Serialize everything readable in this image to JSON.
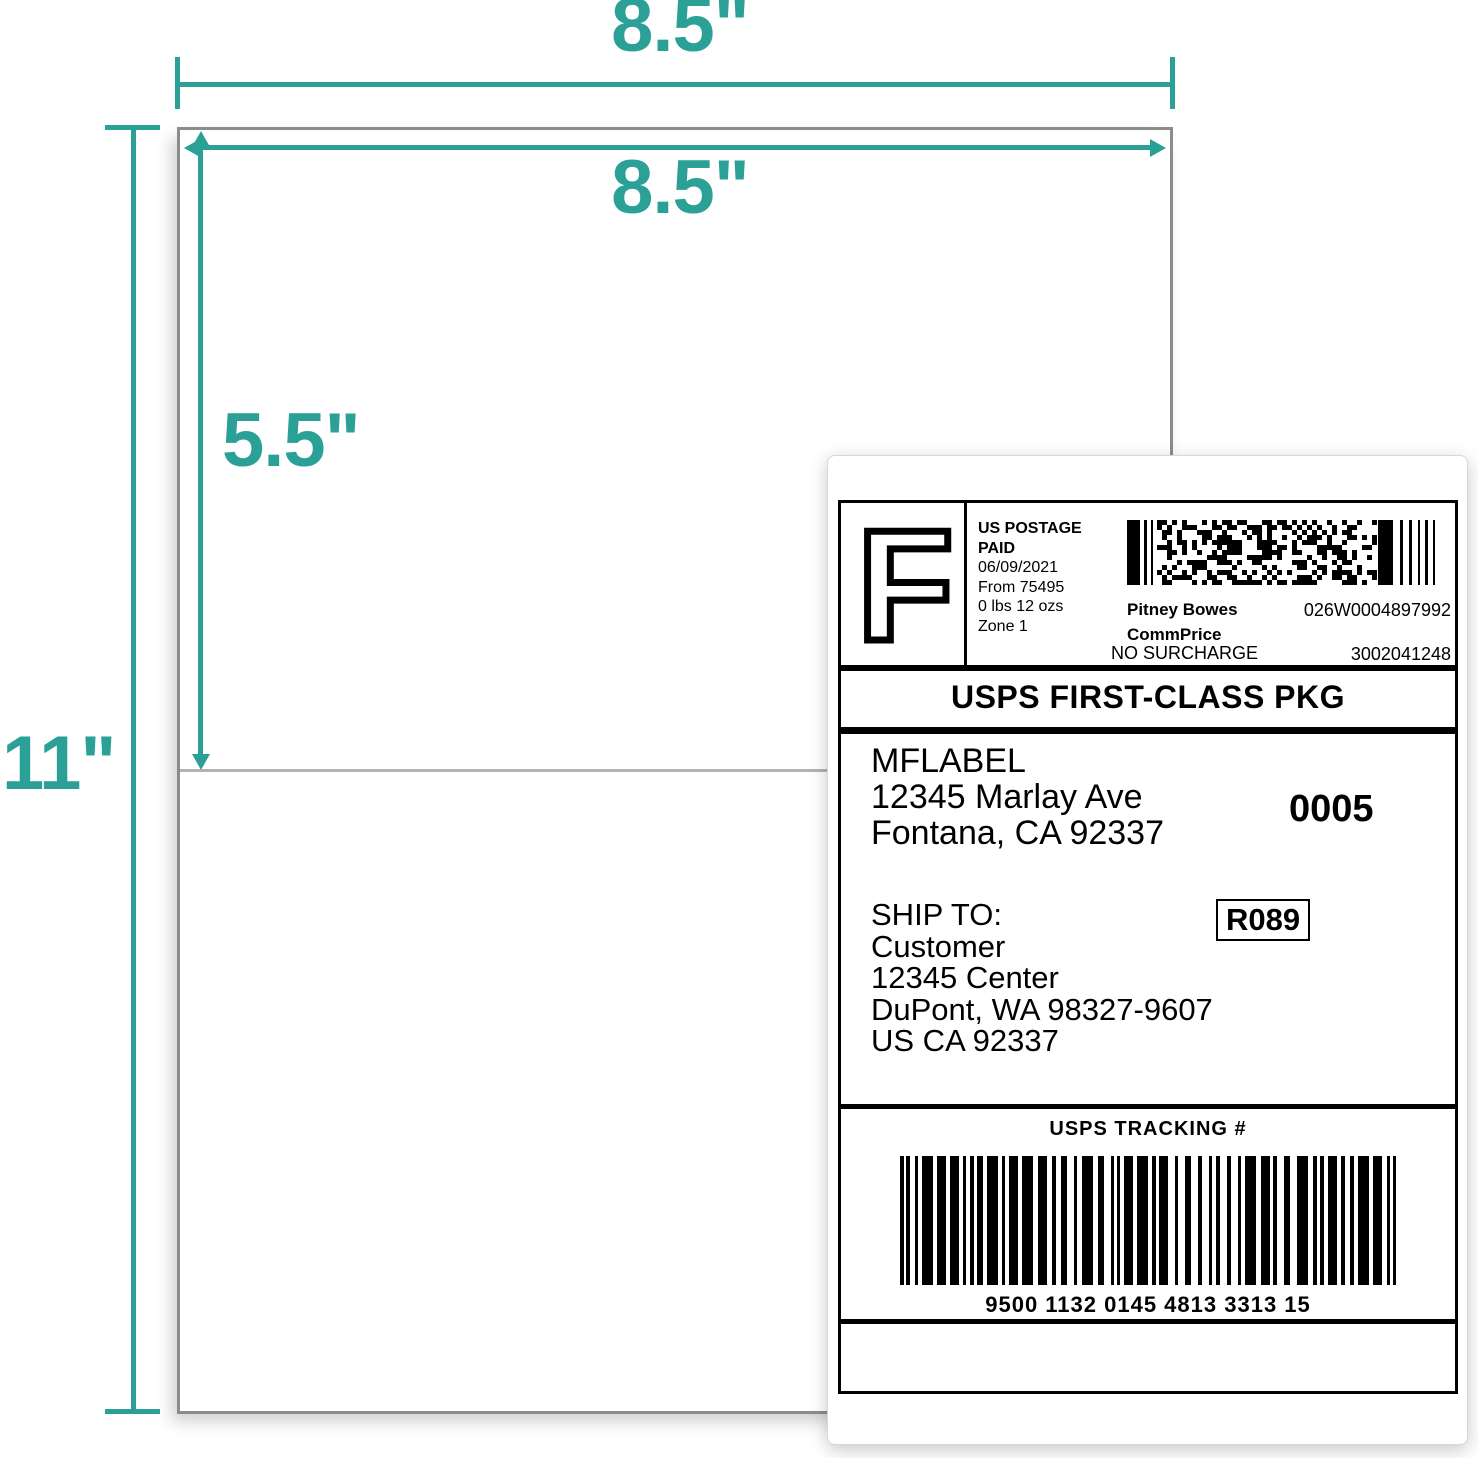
{
  "colors": {
    "accent": "#2aa096",
    "sheet_border": "#8c8c8c",
    "divider": "#b3b3b3"
  },
  "annotations": {
    "outer_width": "8.5\"",
    "inner_width": "8.5\"",
    "half_height": "5.5\"",
    "page_height": "11\""
  },
  "label": {
    "postage": {
      "stamp_letter": "F",
      "heading_line1": "US POSTAGE",
      "heading_line2": "PAID",
      "date": "06/09/2021",
      "origin": "From 75495",
      "weight": "0 lbs 12 ozs",
      "zone": "Zone 1",
      "carrier": "Pitney Bowes",
      "rate_tier": "CommPrice",
      "surcharge": "NO SURCHARGE",
      "meter_id": "026W0004897992",
      "serial": "3002041248"
    },
    "service": "USPS FIRST-CLASS PKG",
    "sender": {
      "name": "MFLABEL",
      "street": "12345 Marlay Ave",
      "city": "Fontana, CA 92337",
      "batch": "0005"
    },
    "ship_to": {
      "heading": "SHIP TO:",
      "name": "Customer",
      "street": "12345 Center",
      "city": "DuPont, WA 98327-9607",
      "country": "US CA 92337",
      "route": "R089"
    },
    "tracking": {
      "heading": "USPS TRACKING #",
      "number": "9500 1132 0145 4813 3313 15"
    }
  }
}
